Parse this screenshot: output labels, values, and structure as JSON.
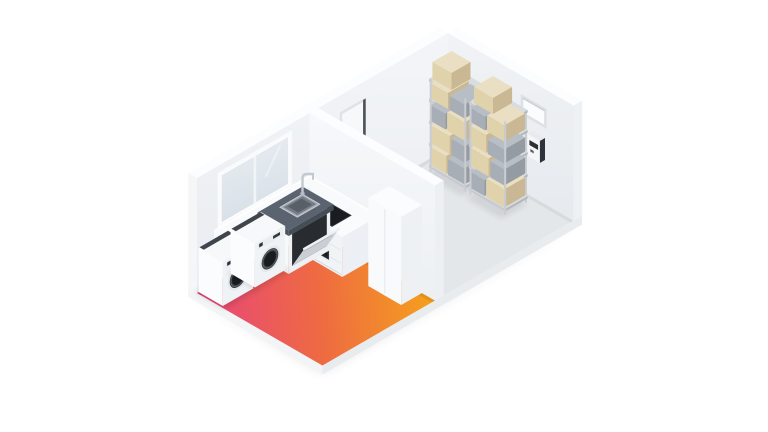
{
  "scene": {
    "title": "isometric-room-cutaway",
    "description": "Isometric cutaway illustration of a kitchen-laundry room with a heat-gradient floor and an adjacent storage room",
    "background": "#ffffff",
    "rooms": [
      {
        "id": "kitchen-laundry",
        "floor": "heat-gradient",
        "objects": [
          "window",
          "washing-machine-left",
          "washing-machine-right",
          "dishwasher",
          "sink-counter",
          "sink-basin",
          "faucet",
          "kitchen-counter-cooktop",
          "cooktop",
          "oven",
          "tall-cabinet",
          "kitchen-backsplash"
        ]
      },
      {
        "id": "storage-room",
        "floor": "plain-gray",
        "objects": [
          "shelving-unit-left",
          "shelving-unit-right",
          "cardboard-boxes",
          "gray-boxes",
          "wall-recess",
          "wall-vent-panel",
          "wall-mounted-controller"
        ]
      }
    ],
    "structure": [
      "floor-slab",
      "back-wall",
      "right-wall",
      "partition-wall",
      "ground-shadow"
    ]
  },
  "colors": {
    "heat_start": "#e8457b",
    "heat_mid": "#ee6a42",
    "heat_end": "#f5a21c",
    "wall_top": "#fcfdfe",
    "wall_end_w": "#f4f6f8",
    "wall_end_e": "#eef1f4",
    "wall_end_p": "#edf0f3",
    "floor_gray": "#e4e7ea",
    "slab_light": "#f3f4f6",
    "slab_shade": "#e9ecef",
    "box_tan": "#e0d2ab",
    "box_tan_side": "#c9b893",
    "box_tan_top": "#eadfc2",
    "box_gray": "#a8aeb5",
    "box_gray_side": "#959ba2",
    "box_gray_top": "#b8bec5",
    "shelf_board": "#dadde0",
    "shelf_board_edge": "#c6cad0",
    "shelf_board_side": "#b4b9bf",
    "shelf_post": "#c9cdd2",
    "appliance_dark": "#24272c",
    "appliance_deep": "#15181b",
    "counter_dark": "#5a636f",
    "counter_dark_l": "#4d5560",
    "counter_dark_r": "#454d57",
    "steel": "#c3c9cf",
    "basin_rim": "#a7aeb6",
    "white_body": "#f6f8fa",
    "white_body_l": "#fafcfd",
    "white_body_r": "#f0f3f6"
  }
}
